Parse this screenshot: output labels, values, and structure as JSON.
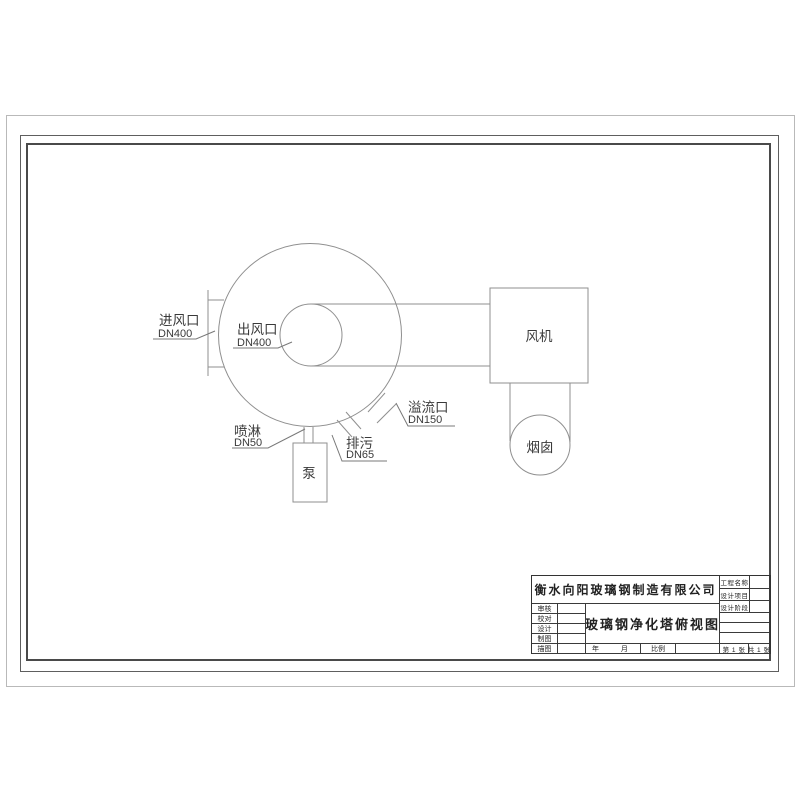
{
  "drawing": {
    "labels": {
      "inlet": {
        "name": "进风口",
        "dn": "DN400"
      },
      "outlet": {
        "name": "出风口",
        "dn": "DN400"
      },
      "spray": {
        "name": "喷淋",
        "dn": "DN50"
      },
      "drain": {
        "name": "排污",
        "dn": "DN65"
      },
      "overflow": {
        "name": "溢流口",
        "dn": "DN150"
      }
    },
    "equipment": {
      "pump": "泵",
      "fan": "风机",
      "chimney": "烟囱"
    }
  },
  "title_block": {
    "company": "衡水向阳玻璃钢制造有限公司",
    "drawing_title": "玻璃钢净化塔俯视图",
    "project_fields": [
      "工程名称",
      "设计项目",
      "设计阶段"
    ],
    "sign_fields": [
      "审核",
      "校对",
      "设计",
      "制图",
      "描图"
    ],
    "date_label": "年  月",
    "scale_label": "比例",
    "sheet_current": "第 1 张",
    "sheet_total": "共 1 张"
  },
  "colors": {
    "drawing_line": "#8f8f8f",
    "frame_line": "#4a4a4a",
    "text": "#3a3a3a",
    "paper_edge": "#b9b9b9",
    "background": "#ffffff"
  }
}
